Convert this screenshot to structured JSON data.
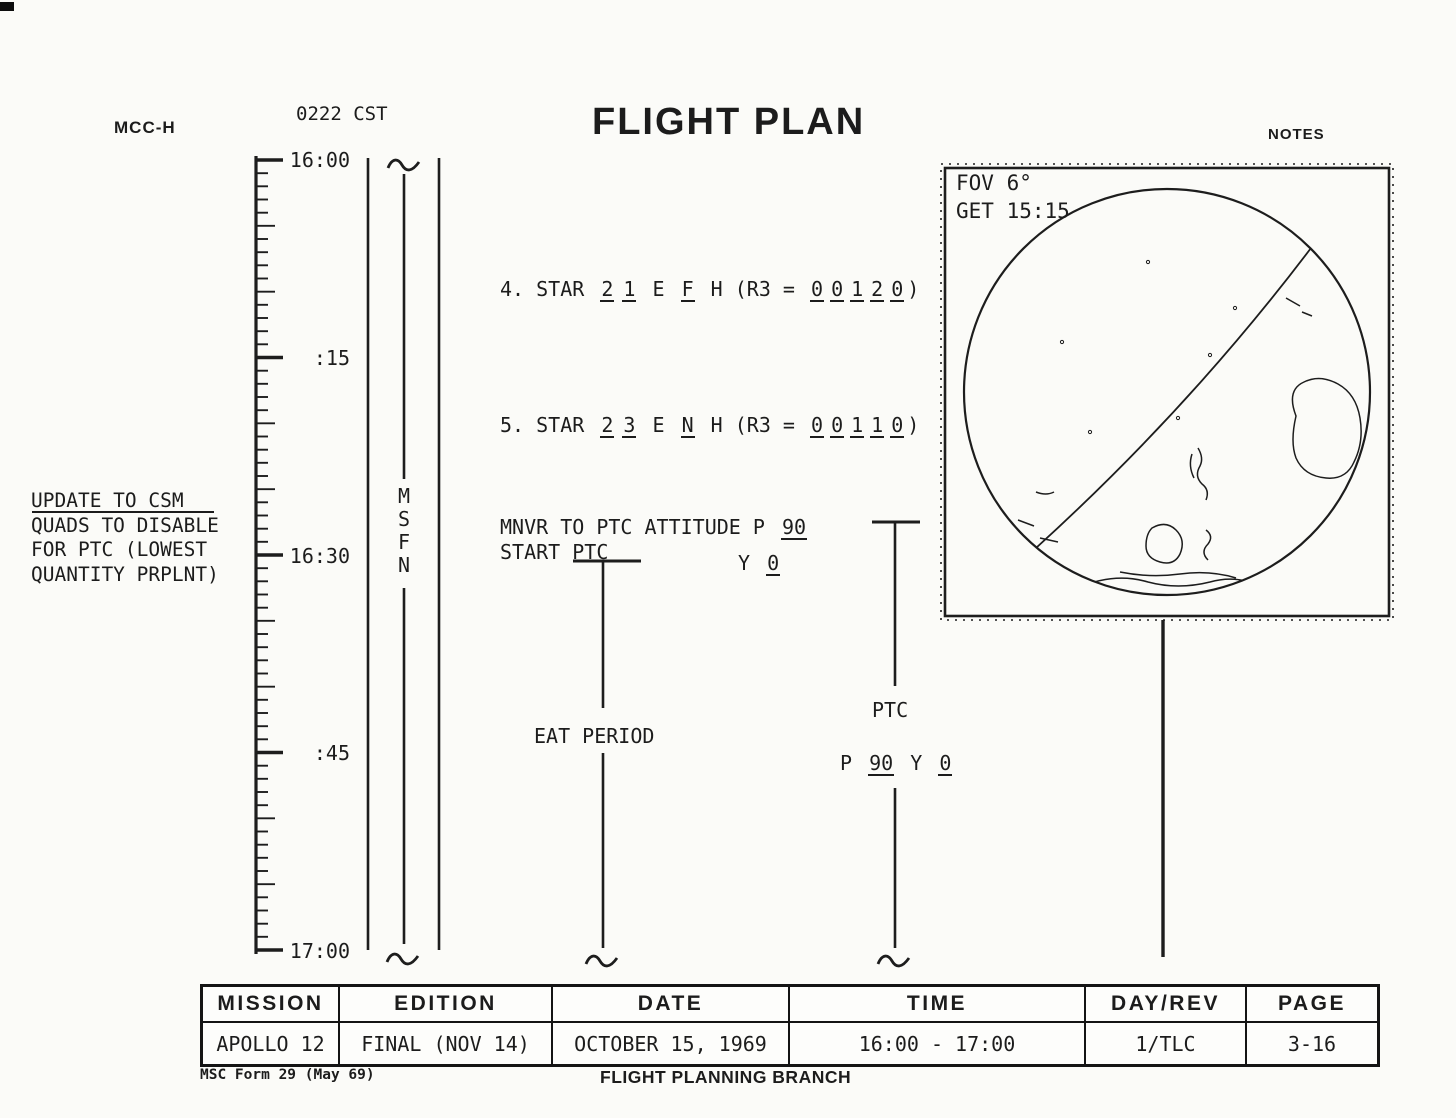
{
  "header": {
    "station": "MCC-H",
    "cst_time": "0222 CST",
    "title": "FLIGHT PLAN",
    "notes_label": "NOTES"
  },
  "timeline": {
    "tick_labels": [
      "16:00",
      ":15",
      "16:30",
      ":45",
      "17:00"
    ],
    "network_letters": [
      "M",
      "S",
      "F",
      "N"
    ]
  },
  "margin_note": {
    "line1": "UPDATE TO CSM",
    "line2": "QUADS TO DISABLE",
    "line3": "FOR PTC (LOWEST",
    "line4": "QUANTITY PRPLNT)"
  },
  "activities": {
    "star4": {
      "prefix": "4. STAR",
      "s1": "2",
      "s2": "1",
      "m1": "E",
      "s3": "F",
      "m2": "H (R3 =",
      "d1": "0",
      "d2": "0",
      "d3": "1",
      "d4": "2",
      "d5": "0",
      "suffix": ")"
    },
    "star5": {
      "prefix": "5. STAR",
      "s1": "2",
      "s2": "3",
      "m1": "E",
      "s3": "N",
      "m2": "H (R3 =",
      "d1": "0",
      "d2": "0",
      "d3": "1",
      "d4": "1",
      "d5": "0",
      "suffix": ")"
    },
    "mnvr": {
      "line1": "MNVR TO PTC ATTITUDE P",
      "pitch": "90",
      "line2": "START PTC",
      "y_label": "Y",
      "yaw": "0"
    },
    "eat_label": "EAT PERIOD",
    "ptc": {
      "label": "PTC",
      "p_label": "P",
      "pitch": "90",
      "y_label": "Y",
      "yaw": "0"
    }
  },
  "globe": {
    "fov": "FOV 6°",
    "get": "GET 15:15"
  },
  "footer_table": {
    "columns": [
      {
        "header": "MISSION",
        "value": "APOLLO 12"
      },
      {
        "header": "EDITION",
        "value": "FINAL (NOV 14)"
      },
      {
        "header": "DATE",
        "value": "OCTOBER 15, 1969"
      },
      {
        "header": "TIME",
        "value": "16:00 - 17:00"
      },
      {
        "header": "DAY/REV",
        "value": "1/TLC"
      },
      {
        "header": "PAGE",
        "value": "3-16"
      }
    ]
  },
  "footer": {
    "form": "MSC Form 29 (May 69)",
    "branch": "FLIGHT PLANNING BRANCH"
  },
  "colors": {
    "ink": "#1c1c1c",
    "paper": "#fbfbf8"
  }
}
